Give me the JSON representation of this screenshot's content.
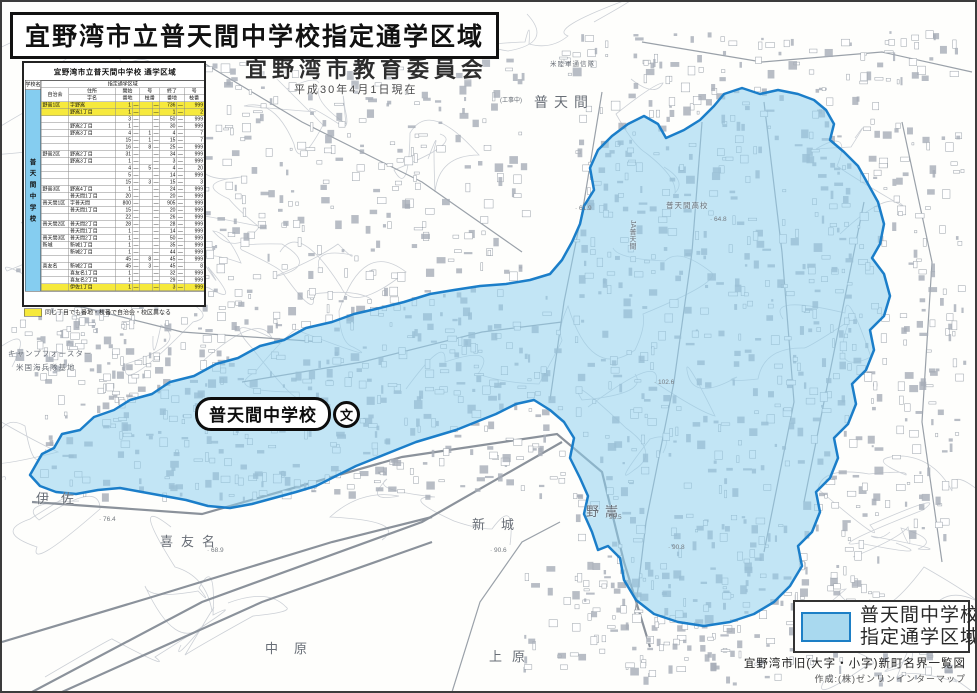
{
  "title": "宜野湾市立普天間中学校指定通学区域",
  "subtitle": "宜野湾市教育委員会",
  "subtitle_date": "平成30年4月1日現在",
  "table": {
    "title": "宜野湾市立普天間中学校 通学区域",
    "school_col_header": "学校名",
    "school_name_vertical": "普天間中学校",
    "area_header": "指定通学区域",
    "headers": {
      "assoc": "自治会",
      "addr": "住所",
      "aza": "字名",
      "start": "開始",
      "end": "終了",
      "go": "号",
      "banchi": "番地",
      "edaban": "枝番"
    },
    "rows": [
      [
        "野嵩1区",
        "字野嵩",
        "1",
        "",
        "736",
        "999",
        true
      ],
      [
        "",
        "野嵩1丁目",
        "1",
        "",
        "1",
        "2",
        true
      ],
      [
        "",
        "",
        "3",
        "",
        "50",
        "999",
        false
      ],
      [
        "",
        "野嵩2丁目",
        "1",
        "",
        "30",
        "999",
        false
      ],
      [
        "",
        "野嵩3丁目",
        "4",
        "1",
        "4",
        "7",
        false
      ],
      [
        "",
        "",
        "15",
        "1",
        "15",
        "7",
        false
      ],
      [
        "",
        "",
        "16",
        "8",
        "25",
        "999",
        false
      ],
      [
        "野嵩2区",
        "野嵩2丁目",
        "31",
        "",
        "34",
        "999",
        false
      ],
      [
        "",
        "野嵩3丁目",
        "1",
        "",
        "3",
        "999",
        false
      ],
      [
        "",
        "",
        "4",
        "5",
        "4",
        "20",
        false
      ],
      [
        "",
        "",
        "5",
        "",
        "14",
        "999",
        false
      ],
      [
        "",
        "",
        "15",
        "3",
        "15",
        "3",
        false
      ],
      [
        "野嵩3区",
        "野嵩4丁目",
        "1",
        "",
        "24",
        "999",
        false
      ],
      [
        "",
        "普天間1丁目",
        "20",
        "",
        "20",
        "999",
        false
      ],
      [
        "普天間1区",
        "字普天間",
        "800",
        "",
        "905",
        "999",
        false
      ],
      [
        "",
        "普天間1丁目",
        "15",
        "",
        "20",
        "999",
        false
      ],
      [
        "",
        "",
        "22",
        "",
        "26",
        "999",
        false
      ],
      [
        "普天間2区",
        "普天間2丁目",
        "28",
        "",
        "28",
        "999",
        false
      ],
      [
        "",
        "普天間1丁目",
        "1",
        "",
        "14",
        "999",
        false
      ],
      [
        "普天間3区",
        "普天間2丁目",
        "1",
        "",
        "50",
        "999",
        false
      ],
      [
        "新城",
        "新城1丁目",
        "1",
        "",
        "35",
        "999",
        false
      ],
      [
        "",
        "新城2丁目",
        "1",
        "",
        "44",
        "999",
        false
      ],
      [
        "",
        "",
        "45",
        "8",
        "45",
        "999",
        false
      ],
      [
        "喜友名",
        "新城2丁目",
        "45",
        "3",
        "45",
        "8",
        false
      ],
      [
        "",
        "喜友名1丁目",
        "1",
        "",
        "32",
        "999",
        false
      ],
      [
        "",
        "喜友名2丁目",
        "1",
        "",
        "29",
        "999",
        false
      ],
      [
        "",
        "伊佐1丁目",
        "1",
        "",
        "3",
        "999",
        true
      ]
    ],
    "note": "同じ丁目でも番地・枝番で自治会・校区異なる"
  },
  "school_marker": {
    "label": "普天間中学校",
    "symbol": "文"
  },
  "legend": {
    "line1": "普天間中学校",
    "line2": "指定通学区域",
    "swatch_fill": "#a9d9ef",
    "swatch_border": "#1d7fc6"
  },
  "footer": {
    "line1": "宜野湾市旧(大字・小字)新町名界一覧図",
    "line2": "作成:(株)ゼンリンインターマップ"
  },
  "map_labels": [
    {
      "t": "普天間",
      "x": 532,
      "y": 90,
      "s": 14,
      "ls": 6
    },
    {
      "t": "米陸軍通信隊",
      "x": 548,
      "y": 56,
      "s": 6.5,
      "ls": 1
    },
    {
      "t": "(工事中)",
      "x": 498,
      "y": 93,
      "s": 6,
      "ls": 0
    },
    {
      "t": "普天間高校",
      "x": 664,
      "y": 198,
      "s": 7.5,
      "ls": 1
    },
    {
      "t": "JA普天間",
      "x": 625,
      "y": 218,
      "s": 7,
      "ls": 0,
      "v": 1
    },
    {
      "t": "伊佐",
      "x": 34,
      "y": 486,
      "s": 13,
      "ls": 12
    },
    {
      "t": "喜友名",
      "x": 158,
      "y": 529,
      "s": 13,
      "ls": 8
    },
    {
      "t": "新城",
      "x": 470,
      "y": 512,
      "s": 13,
      "ls": 16
    },
    {
      "t": "野嵩",
      "x": 584,
      "y": 499,
      "s": 13,
      "ls": 6
    },
    {
      "t": "中原",
      "x": 263,
      "y": 636,
      "s": 13,
      "ls": 16
    },
    {
      "t": "上原",
      "x": 487,
      "y": 644,
      "s": 13,
      "ls": 10
    },
    {
      "t": "キャンプフォースター",
      "x": 6,
      "y": 346,
      "s": 7.5,
      "ls": 1
    },
    {
      "t": "米国海兵隊基地",
      "x": 14,
      "y": 360,
      "s": 7.5,
      "ls": 1
    }
  ],
  "elevation_labels": [
    {
      "t": "76.4",
      "x": 97,
      "y": 514
    },
    {
      "t": "68.9",
      "x": 205,
      "y": 545
    },
    {
      "t": "90.6",
      "x": 488,
      "y": 545
    },
    {
      "t": "96.5",
      "x": 603,
      "y": 512
    },
    {
      "t": "64.8",
      "x": 708,
      "y": 214
    },
    {
      "t": "61.9",
      "x": 573,
      "y": 203
    },
    {
      "t": "102.6",
      "x": 652,
      "y": 377
    },
    {
      "t": "90.8",
      "x": 666,
      "y": 542
    }
  ],
  "colors": {
    "district_fill": "#8fd0ee",
    "district_border": "#1b7ec9",
    "highlight_yellow": "#f6e93c",
    "school_col_blue": "#85cdf0"
  }
}
